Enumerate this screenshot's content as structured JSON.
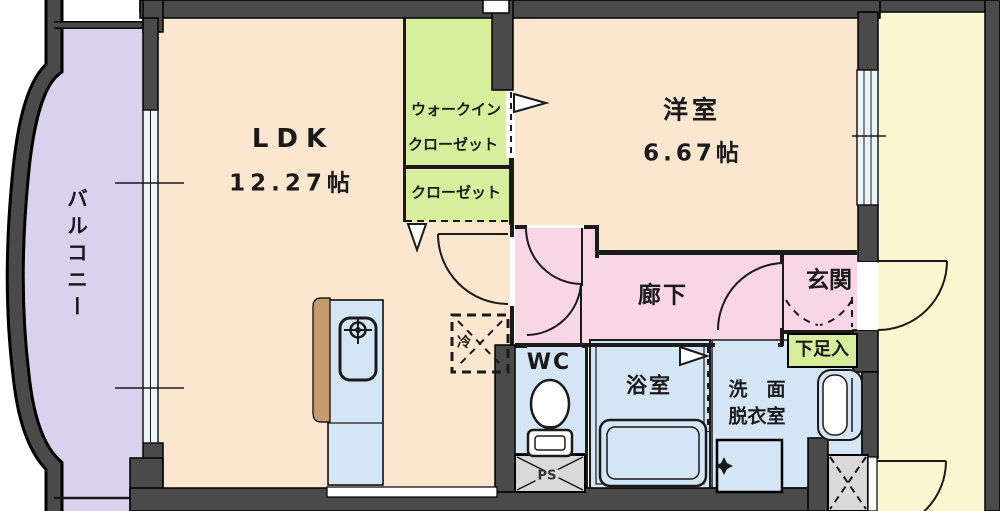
{
  "plan_title": "1LDK apartment floor plan",
  "rooms": {
    "ldk": {
      "label": "LDK",
      "size": "12.27帖"
    },
    "western_room": {
      "label": "洋室",
      "size": "6.67帖"
    },
    "walk_in_closet": {
      "label_line1": "ウォークイン",
      "label_line2": "クローゼット"
    },
    "closet": {
      "label": "クローゼット"
    },
    "balcony": {
      "label": "バルコニー"
    },
    "hallway": {
      "label": "廊下"
    },
    "entrance": {
      "label": "玄関"
    },
    "shoe_box": {
      "label": "下足入"
    },
    "wc": {
      "label": "WC"
    },
    "pipe_space": {
      "label": "PS"
    },
    "bathroom": {
      "label": "浴室"
    },
    "washroom": {
      "label_line1": "洗　面",
      "label_line2": "脱衣室"
    },
    "refrigerator": {
      "label": "冷"
    }
  },
  "colors": {
    "room_peach": "#fbe7d0",
    "room_pink": "#f9d6e4",
    "room_blue": "#d4e5f5",
    "room_green": "#d7ee9d",
    "balcony_lavender": "#d9d2ee",
    "corridor_yellow": "#fbf7d0",
    "wall_dark": "#4a4a4a",
    "ps_gray": "#d9d9d9",
    "counter_brown": "#c59a6d",
    "window_glass": "#eaf5fb",
    "line_black": "#1a1a1a"
  }
}
